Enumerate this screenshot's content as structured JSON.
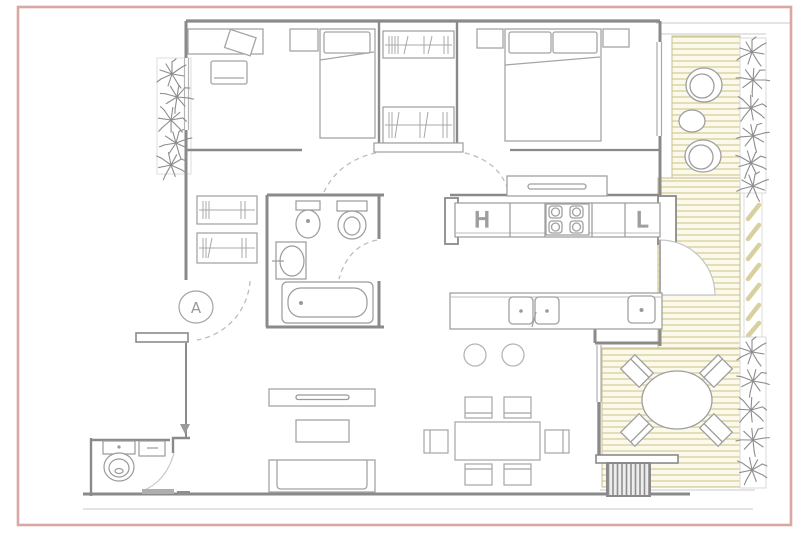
{
  "image": {
    "kind": "apartment-floor-plan-photo"
  },
  "labels": {
    "kitchen_h": "H",
    "kitchen_l": "L",
    "entry_marker": "A"
  },
  "palette": {
    "frame_pink": "#d9a8a3",
    "wall_gray": "#8a8a8a",
    "furniture_gray": "#a5a5a5",
    "deck_stripe": "#d8cf9a",
    "deck_background": "#fbf9ec",
    "plant_gray": "#8d8d8d",
    "hatch_gray": "#909090"
  }
}
